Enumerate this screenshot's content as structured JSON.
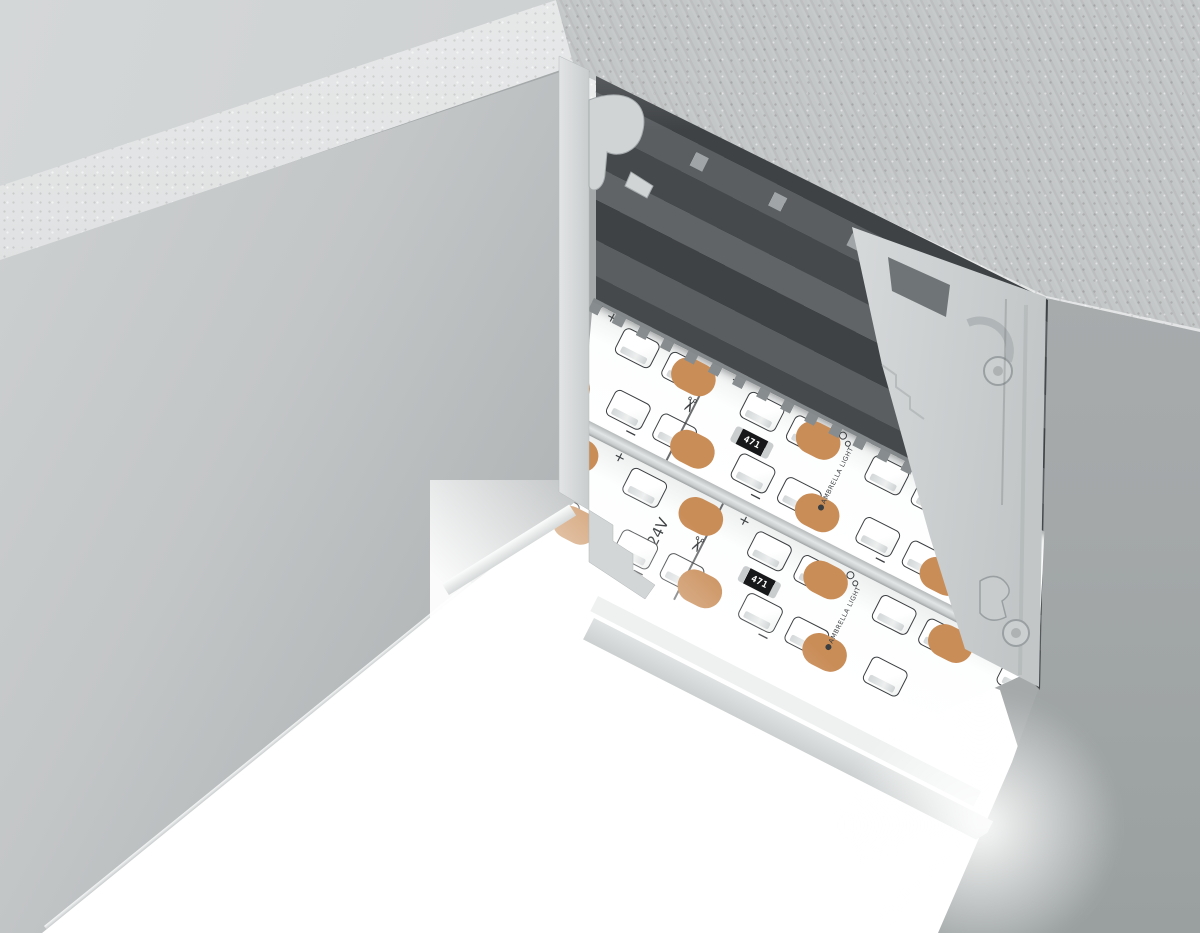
{
  "led_strip": {
    "brand_label": "AMBRELLA LIGHT",
    "voltage_label": "24V",
    "resistor_label": "471",
    "plus_label": "+",
    "minus_label": "−"
  },
  "icons": {
    "scissors_icon": "✂"
  },
  "colors": {
    "copper_pad": "#c98d58",
    "pcb_white": "#fdfefe",
    "silkscreen_dark": "#3b3e40",
    "resistor_black": "#17181a",
    "aluminum_light": "#d3d6d7",
    "cavity_dark": "#515558",
    "concrete_gray": "#c4c7c8",
    "glow_white": "#ffffff"
  }
}
